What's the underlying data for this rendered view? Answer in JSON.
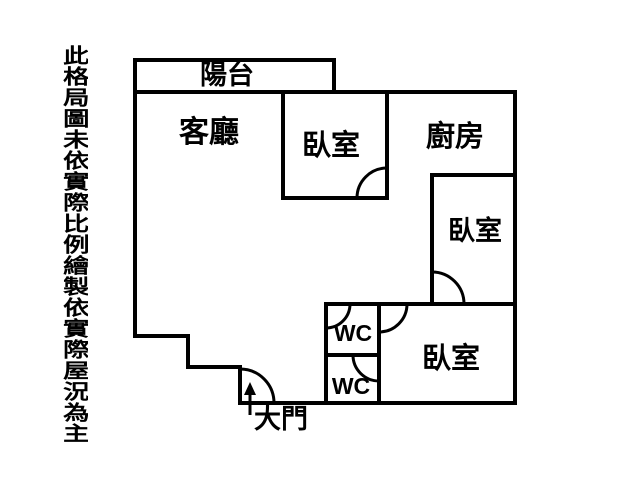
{
  "canvas": {
    "width": 640,
    "height": 480,
    "background_color": "#ffffff",
    "line_color": "#000000"
  },
  "disclaimer": {
    "text": "此格局圖未依實際比例繪製依實際屋況為主"
  },
  "floorplan": {
    "rooms": [
      {
        "id": "balcony",
        "label": "陽台"
      },
      {
        "id": "living-room",
        "label": "客廳"
      },
      {
        "id": "bedroom-top",
        "label": "臥室"
      },
      {
        "id": "kitchen",
        "label": "廚房"
      },
      {
        "id": "bedroom-right",
        "label": "臥室"
      },
      {
        "id": "wc-upper",
        "label": "WC"
      },
      {
        "id": "wc-lower",
        "label": "WC"
      },
      {
        "id": "bedroom-bottom",
        "label": "臥室"
      },
      {
        "id": "entrance",
        "label": "大門"
      }
    ]
  }
}
